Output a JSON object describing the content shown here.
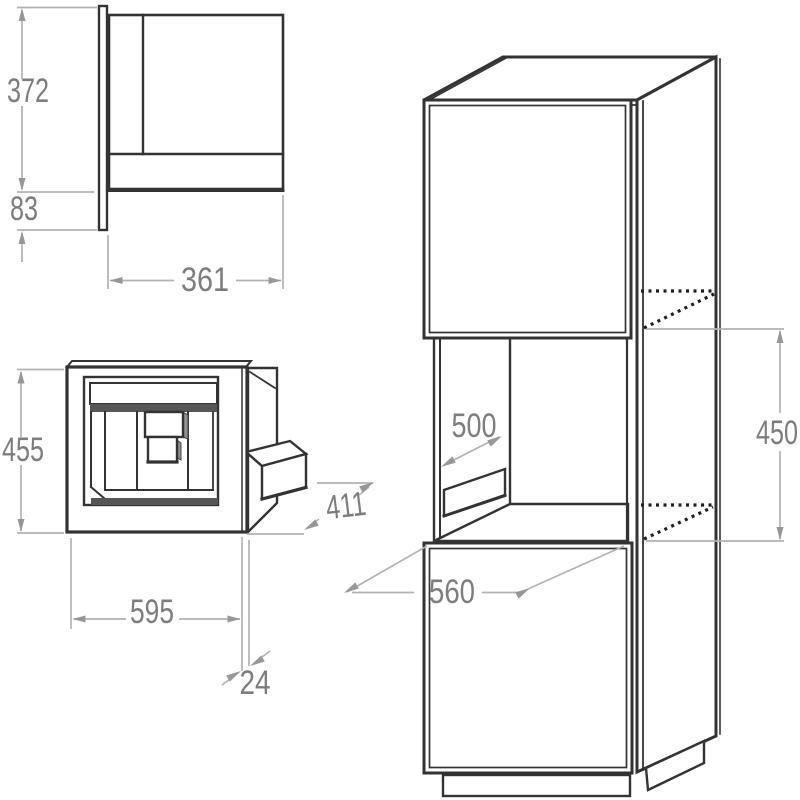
{
  "diagram": {
    "type": "appliance-installation-drawing",
    "unit": "mm",
    "views": {
      "side": {
        "dims": {
          "upper_height": "372",
          "lower_height": "83",
          "depth": "361"
        }
      },
      "front": {
        "dims": {
          "height": "455",
          "width": "595",
          "panel_thickness": "24",
          "body_depth": "411"
        }
      },
      "cabinet": {
        "dims": {
          "niche_depth": "500",
          "niche_height": "450",
          "base_depth": "560"
        }
      }
    },
    "colors": {
      "line": "#333333",
      "dimension_line": "#b2b2b2",
      "dimension_text": "#7d7d7d",
      "shading": "#565656",
      "background": "#ffffff"
    }
  }
}
